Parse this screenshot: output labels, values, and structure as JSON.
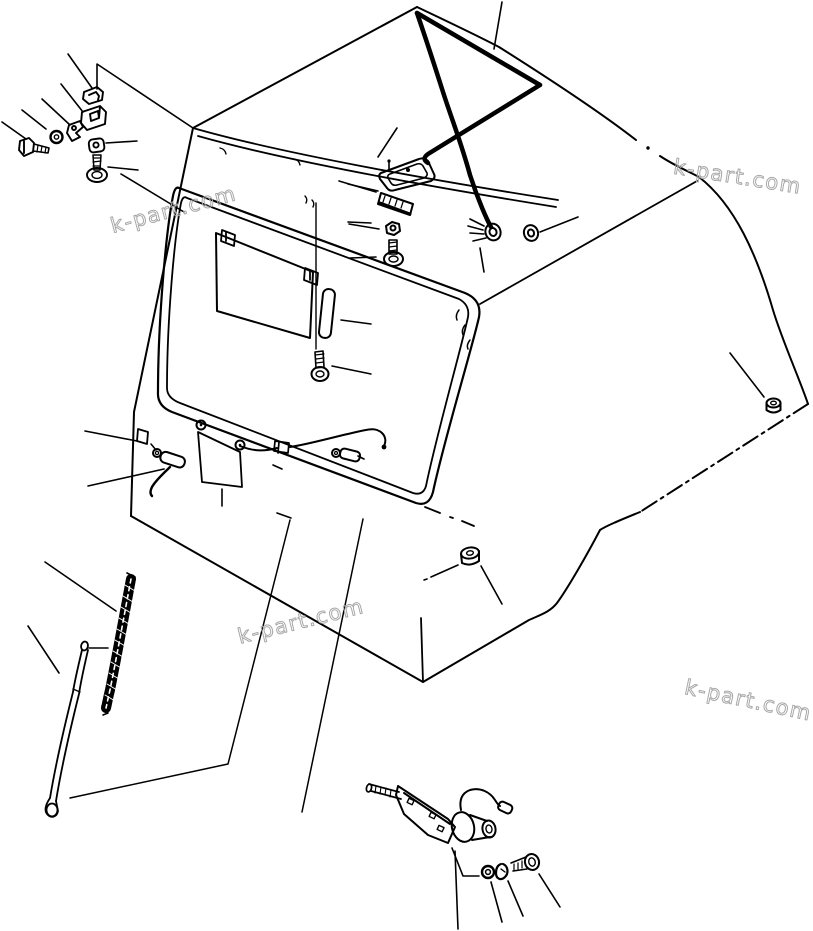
{
  "page": {
    "background": "#ffffff",
    "line_color": "#000000",
    "description_label": ""
  },
  "watermark": {
    "text": "k-part.com",
    "color": "#a8a8a8"
  }
}
